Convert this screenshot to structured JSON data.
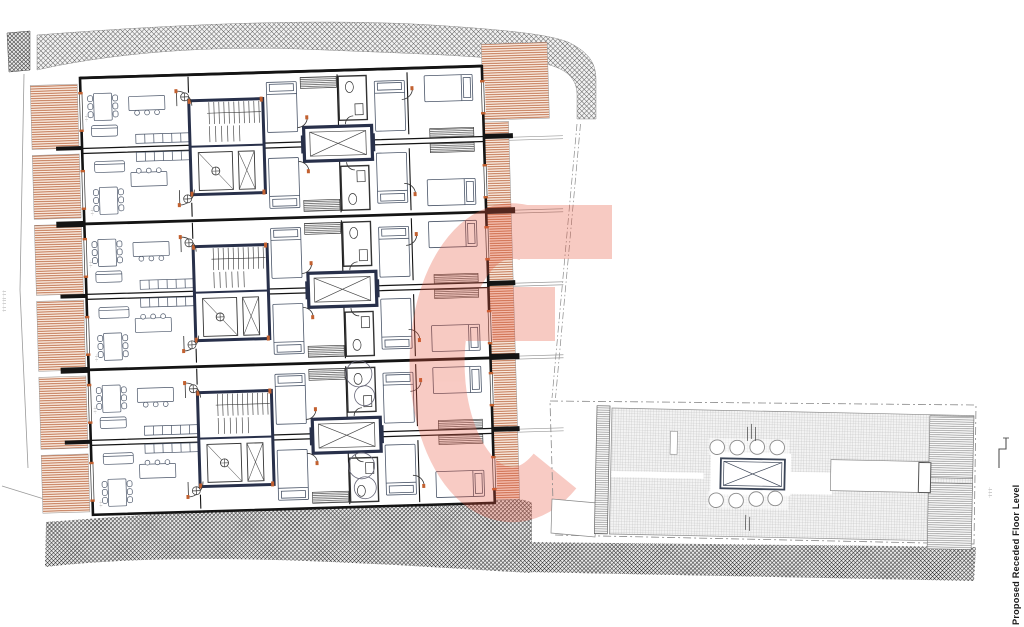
{
  "drawing": {
    "title": "Proposed Receded Floor Level",
    "watermark": {
      "glyph": "e",
      "color": "#e8543a",
      "opacity": 0.3
    },
    "micro_notes": {
      "left_margin": "·|··|···|··|·|···|··|·",
      "roof_level_marker": "··|··|··|··",
      "room_label": "··|··|··"
    },
    "main_plan": {
      "bands": 3,
      "apartments_per_band": 2,
      "elements": [
        "living-dining rooms",
        "stair core",
        "lift shaft",
        "bedrooms",
        "bathrooms",
        "balcony decking strips"
      ]
    },
    "roof_plan": {
      "planter_circles_top": 4,
      "planter_circles_bottom": 4,
      "rooflight": "x-braced shaft"
    },
    "colors": {
      "wall": "#141414",
      "core_wall": "#28304a",
      "deck_line": "#b55c33",
      "deck_bg": "#fbeee4",
      "site_hatch": "#3f3f3f",
      "accent": "#c2602f",
      "watermark": "#e8543a",
      "roof_grid": "#b9b9b9",
      "furniture": "#4a5568"
    }
  }
}
